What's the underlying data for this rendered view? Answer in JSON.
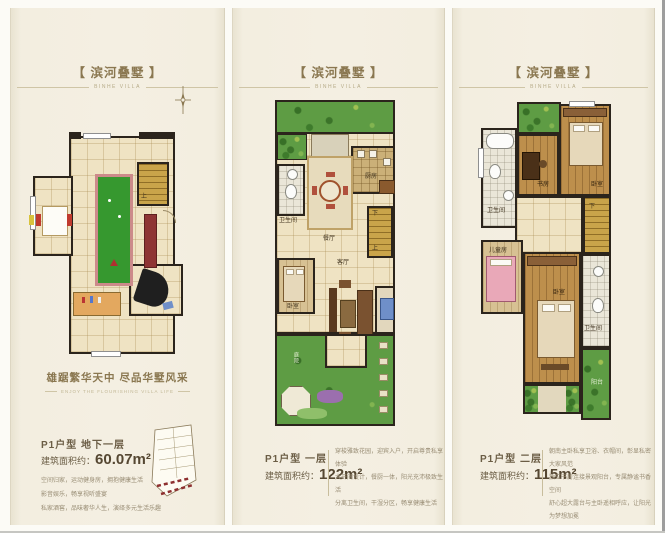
{
  "colors": {
    "accent": "#8a7750",
    "panel_bg": "#f3eee1",
    "garden_green": "#5e9c44",
    "wood_floor": "#bd8f4c",
    "stairs_gold": "#c9a44a",
    "billiard_green": "#36982f",
    "bar_red": "#8e3434"
  },
  "icons": {
    "compass": "compass-rose",
    "keyplan": "isometric-building-key"
  },
  "panels": [
    {
      "title": "【 滨河叠墅 】",
      "subtitle": "BINHE VILLA",
      "tagline": "雄踞繁华天中  尽品华墅风采",
      "tagline_sub": "ENJOY THE FLOURISHING VILLA LIFE",
      "unit": "P1户型  地下一层",
      "area_prefix": "建筑面积约：",
      "area": "60.07m²",
      "desc": [
        "空间归家，运动健身房，拥抱健康生活",
        "影音娱乐，畅享视听盛宴",
        "私家酒窖，品味奢华人生，演绎多元生活乐趣"
      ],
      "plan_labels": {
        "stairs_up": "上"
      }
    },
    {
      "title": "【 滨河叠墅 】",
      "subtitle": "BINHE VILLA",
      "unit": "P1户型  一层",
      "area_prefix": "建筑面积约：",
      "area": "122m²",
      "desc": [
        "穿梭雅致花园，迎宾入户，开启尊贵私享体验",
        "大开间设计，餐厨一体，阳光充沛极致生活",
        "分离卫生间，干湿分区，畅享健康生活"
      ],
      "plan_labels": {
        "bath": "卫生间",
        "dining": "餐厅",
        "kitchen": "厨房",
        "living": "客厅",
        "bedroom": "卧室",
        "stairs_up": "上",
        "stairs_down": "下",
        "yard": "庭院"
      }
    },
    {
      "title": "【 滨河叠墅 】",
      "subtitle": "BINHE VILLA",
      "unit": "P1户型  二层",
      "area_prefix": "建筑面积约：",
      "area": "115m²",
      "desc": [
        "朝南主卧私享卫浴、衣帽间，彰显私密大家风范",
        "独立书房连接景观阳台，专属静谧书香空间",
        "舒心超大露台与主卧遥相呼应，让阳光为梦想加冕"
      ],
      "plan_labels": {
        "study": "书房",
        "bedroom_top": "卧室",
        "bath_left": "卫生间",
        "kids": "儿童房",
        "bedroom_main": "卧室",
        "bath_right": "卫生间",
        "balcony": "阳台",
        "stairs_down": "下"
      }
    }
  ]
}
